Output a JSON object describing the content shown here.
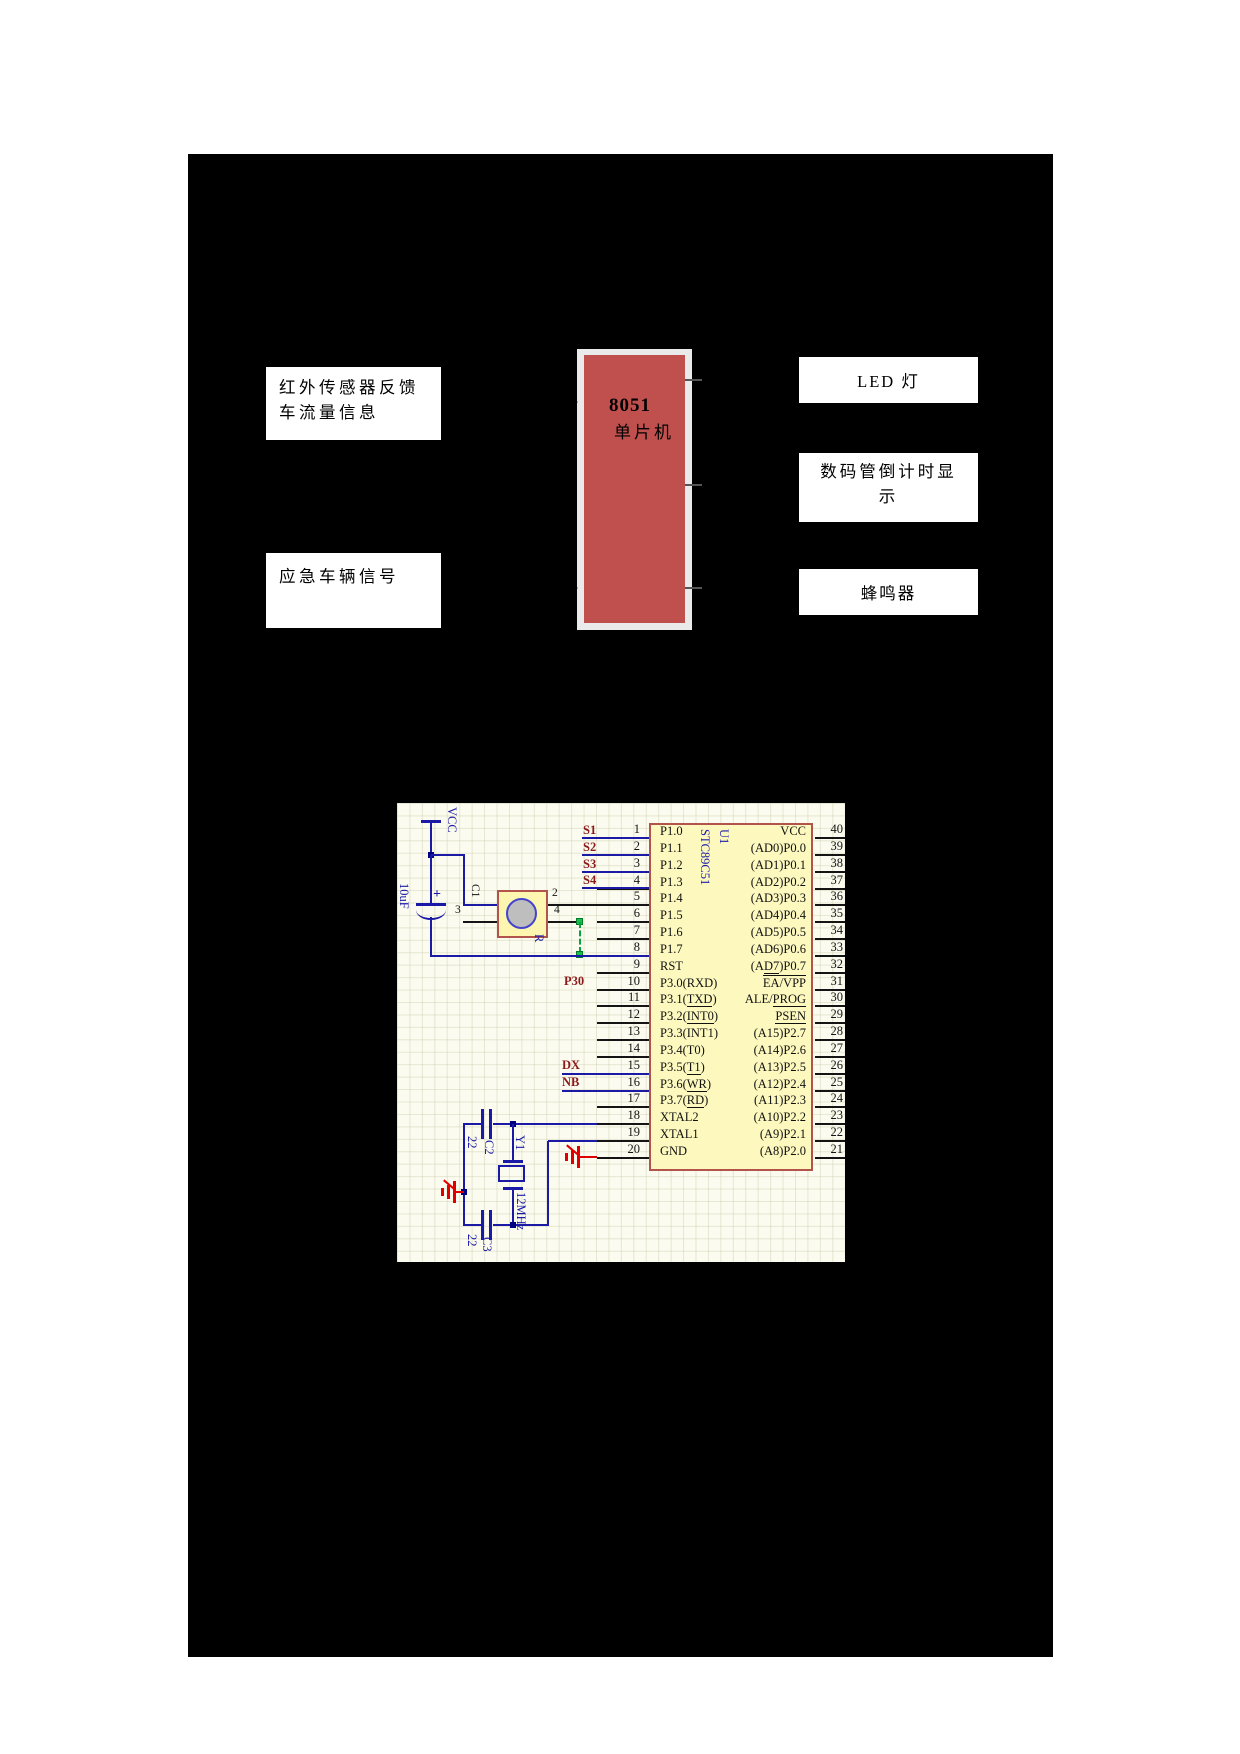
{
  "page": {
    "background": "#ffffff",
    "panel_background": "#000000"
  },
  "block_diagram": {
    "infrared": {
      "line1": "红外传感器反馈",
      "line2": "车流量信息"
    },
    "emergency": {
      "label": "应急车辆信号"
    },
    "mcu": {
      "title": "8051",
      "subtitle": "单片机",
      "fill_color": "#C0504D",
      "frame_color": "#EAEAEA"
    },
    "led": {
      "label": "LED 灯"
    },
    "display": {
      "line1": "数码管倒计时显",
      "line2": "示"
    },
    "buzzer": {
      "label": "蜂鸣器"
    }
  },
  "schematic": {
    "power_label": "VCC",
    "cap1": {
      "value": "10uF",
      "ref": "C1",
      "plus": "+"
    },
    "sensor": {
      "pin2": "2",
      "pin3": "3",
      "pin4": "4",
      "ref": "R"
    },
    "nets": {
      "s1": "S1",
      "s2": "S2",
      "s3": "S3",
      "s4": "S4",
      "p30": "P30",
      "dx": "DX",
      "nb": "NB"
    },
    "xtal": {
      "ref": "Y1",
      "value": "12MHz"
    },
    "cap2": {
      "ref": "C2",
      "value": "22"
    },
    "cap3": {
      "ref": "C3",
      "value": "22"
    },
    "chip": {
      "ref": "U1",
      "part": "STC89C51",
      "left_pins": [
        "1",
        "2",
        "3",
        "4",
        "5",
        "6",
        "7",
        "8",
        "9",
        "10",
        "11",
        "12",
        "13",
        "14",
        "15",
        "16",
        "17",
        "18",
        "19",
        "20"
      ],
      "right_pins": [
        "40",
        "39",
        "38",
        "37",
        "36",
        "35",
        "34",
        "33",
        "32",
        "31",
        "30",
        "29",
        "28",
        "27",
        "26",
        "25",
        "24",
        "23",
        "22",
        "21"
      ],
      "left_labels": [
        [
          {
            "t": "P1.0"
          }
        ],
        [
          {
            "t": "P1.1"
          }
        ],
        [
          {
            "t": "P1.2"
          }
        ],
        [
          {
            "t": "P1.3"
          }
        ],
        [
          {
            "t": "P1.4"
          }
        ],
        [
          {
            "t": "P1.5"
          }
        ],
        [
          {
            "t": "P1.6"
          }
        ],
        [
          {
            "t": "P1.7"
          }
        ],
        [
          {
            "t": "RST"
          }
        ],
        [
          {
            "t": "P3.0(RXD)"
          }
        ],
        [
          {
            "t": "P3.1("
          },
          {
            "t": "TXD",
            "u": true
          },
          {
            "t": ")"
          }
        ],
        [
          {
            "t": "P3.2("
          },
          {
            "t": "INT0",
            "u": true
          },
          {
            "t": ")"
          }
        ],
        [
          {
            "t": "P3.3(INT1)"
          }
        ],
        [
          {
            "t": "P3.4(T0)"
          }
        ],
        [
          {
            "t": "P3.5("
          },
          {
            "t": "T1",
            "u": true
          },
          {
            "t": ")"
          }
        ],
        [
          {
            "t": "P3.6("
          },
          {
            "t": "WR",
            "u": true
          },
          {
            "t": ")"
          }
        ],
        [
          {
            "t": "P3.7("
          },
          {
            "t": "RD",
            "u": true
          },
          {
            "t": ")"
          }
        ],
        [
          {
            "t": "XTAL2"
          }
        ],
        [
          {
            "t": "XTAL1"
          }
        ],
        [
          {
            "t": "GND"
          }
        ]
      ],
      "right_labels": [
        [
          {
            "t": "VCC"
          }
        ],
        [
          {
            "t": "(AD0)P0.0"
          }
        ],
        [
          {
            "t": "(AD1)P0.1"
          }
        ],
        [
          {
            "t": "(AD2)P0.2"
          }
        ],
        [
          {
            "t": "(AD3)P0.3"
          }
        ],
        [
          {
            "t": "(AD4)P0.4"
          }
        ],
        [
          {
            "t": "(AD5)P0.5"
          }
        ],
        [
          {
            "t": "(AD6)P0.6"
          }
        ],
        [
          {
            "t": "(A"
          },
          {
            "t": "D7",
            "u": true
          },
          {
            "t": ")P0.7"
          }
        ],
        [
          {
            "t": "EA/VPP",
            "o": true
          }
        ],
        [
          {
            "t": "ALE/"
          },
          {
            "t": "PROG",
            "u": true
          }
        ],
        [
          {
            "t": "PSEN",
            "u": true
          }
        ],
        [
          {
            "t": "(A15)P2.7"
          }
        ],
        [
          {
            "t": "(A14)P2.6"
          }
        ],
        [
          {
            "t": "(A13)P2.5"
          }
        ],
        [
          {
            "t": "(A12)P2.4"
          }
        ],
        [
          {
            "t": "(A11)P2.3"
          }
        ],
        [
          {
            "t": "(A10)P2.2"
          }
        ],
        [
          {
            "t": "(A9)P2.1"
          }
        ],
        [
          {
            "t": "(A8)P2.0"
          }
        ]
      ]
    },
    "colors": {
      "wire_blue": "#1A1AA6",
      "net_label_red": "#8B1A1A",
      "chip_fill": "#FCF8BE",
      "chip_border": "#B2544C",
      "ground_red": "#E00000",
      "junction_green": "#17C04A",
      "schematic_bg": "#FBFBEF"
    }
  }
}
